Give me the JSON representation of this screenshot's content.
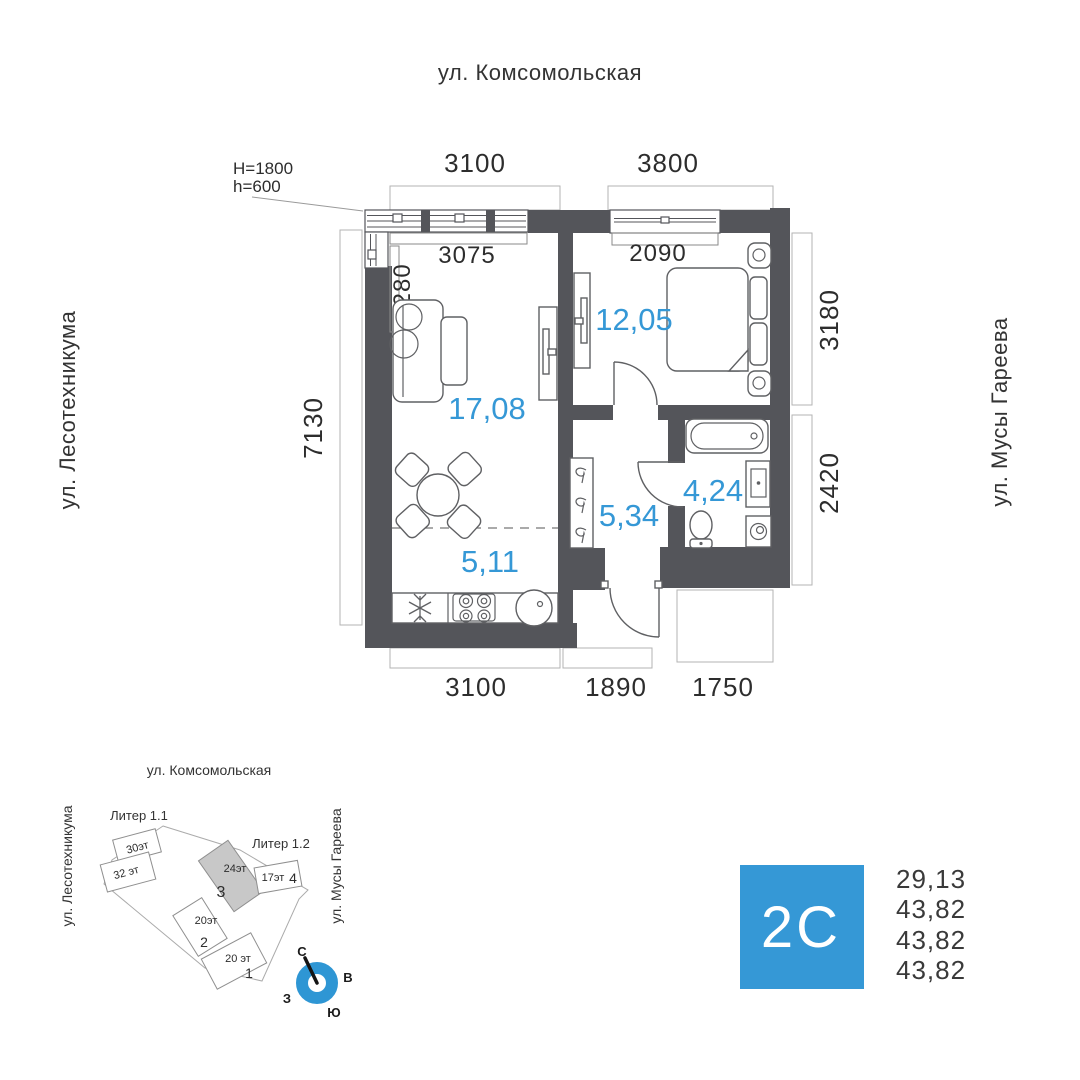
{
  "streets": {
    "top": "ул. Комсомольская",
    "left": "ул. Лесотехникума",
    "right": "ул. Мусы Гареева"
  },
  "floorplan": {
    "annotation": {
      "line1": "H=1800",
      "line2": "h=600"
    },
    "outer_dims": {
      "top_left": "3100",
      "top_right": "3800",
      "left": "7130",
      "right_top": "3180",
      "right_bottom": "2420",
      "bottom_left": "3100",
      "bottom_center": "1890",
      "bottom_right": "1750"
    },
    "inner_dims": {
      "living_width": "3075",
      "living_depth": "1280",
      "bedroom_width": "2090"
    },
    "areas": {
      "living": "17,08",
      "bedroom": "12,05",
      "hall": "5,34",
      "bath": "4,24",
      "kitchen": "5,11"
    }
  },
  "minimap": {
    "street_top": "ул. Комсомольская",
    "street_left": "ул. Лесотехникума",
    "street_right": "ул. Мусы Гареева",
    "liter1": "Литер 1.1",
    "liter2": "Литер 1.2",
    "buildings": [
      {
        "floors": "30эт"
      },
      {
        "floors": "32 эт"
      },
      {
        "floors": "24эт",
        "num": "3"
      },
      {
        "floors": "17эт",
        "num": "4"
      },
      {
        "floors": "20эт",
        "num": "2"
      },
      {
        "floors": "20 эт",
        "num": "1"
      }
    ],
    "compass": {
      "n": "С",
      "e": "В",
      "w": "З",
      "s": "Ю"
    }
  },
  "typecard": {
    "type": "2C",
    "values": [
      "29,13",
      "43,82",
      "43,82",
      "43,82"
    ]
  },
  "colors": {
    "accent": "#3598d6",
    "wall": "#54555a",
    "highlight_building": "#c8c8c8"
  }
}
